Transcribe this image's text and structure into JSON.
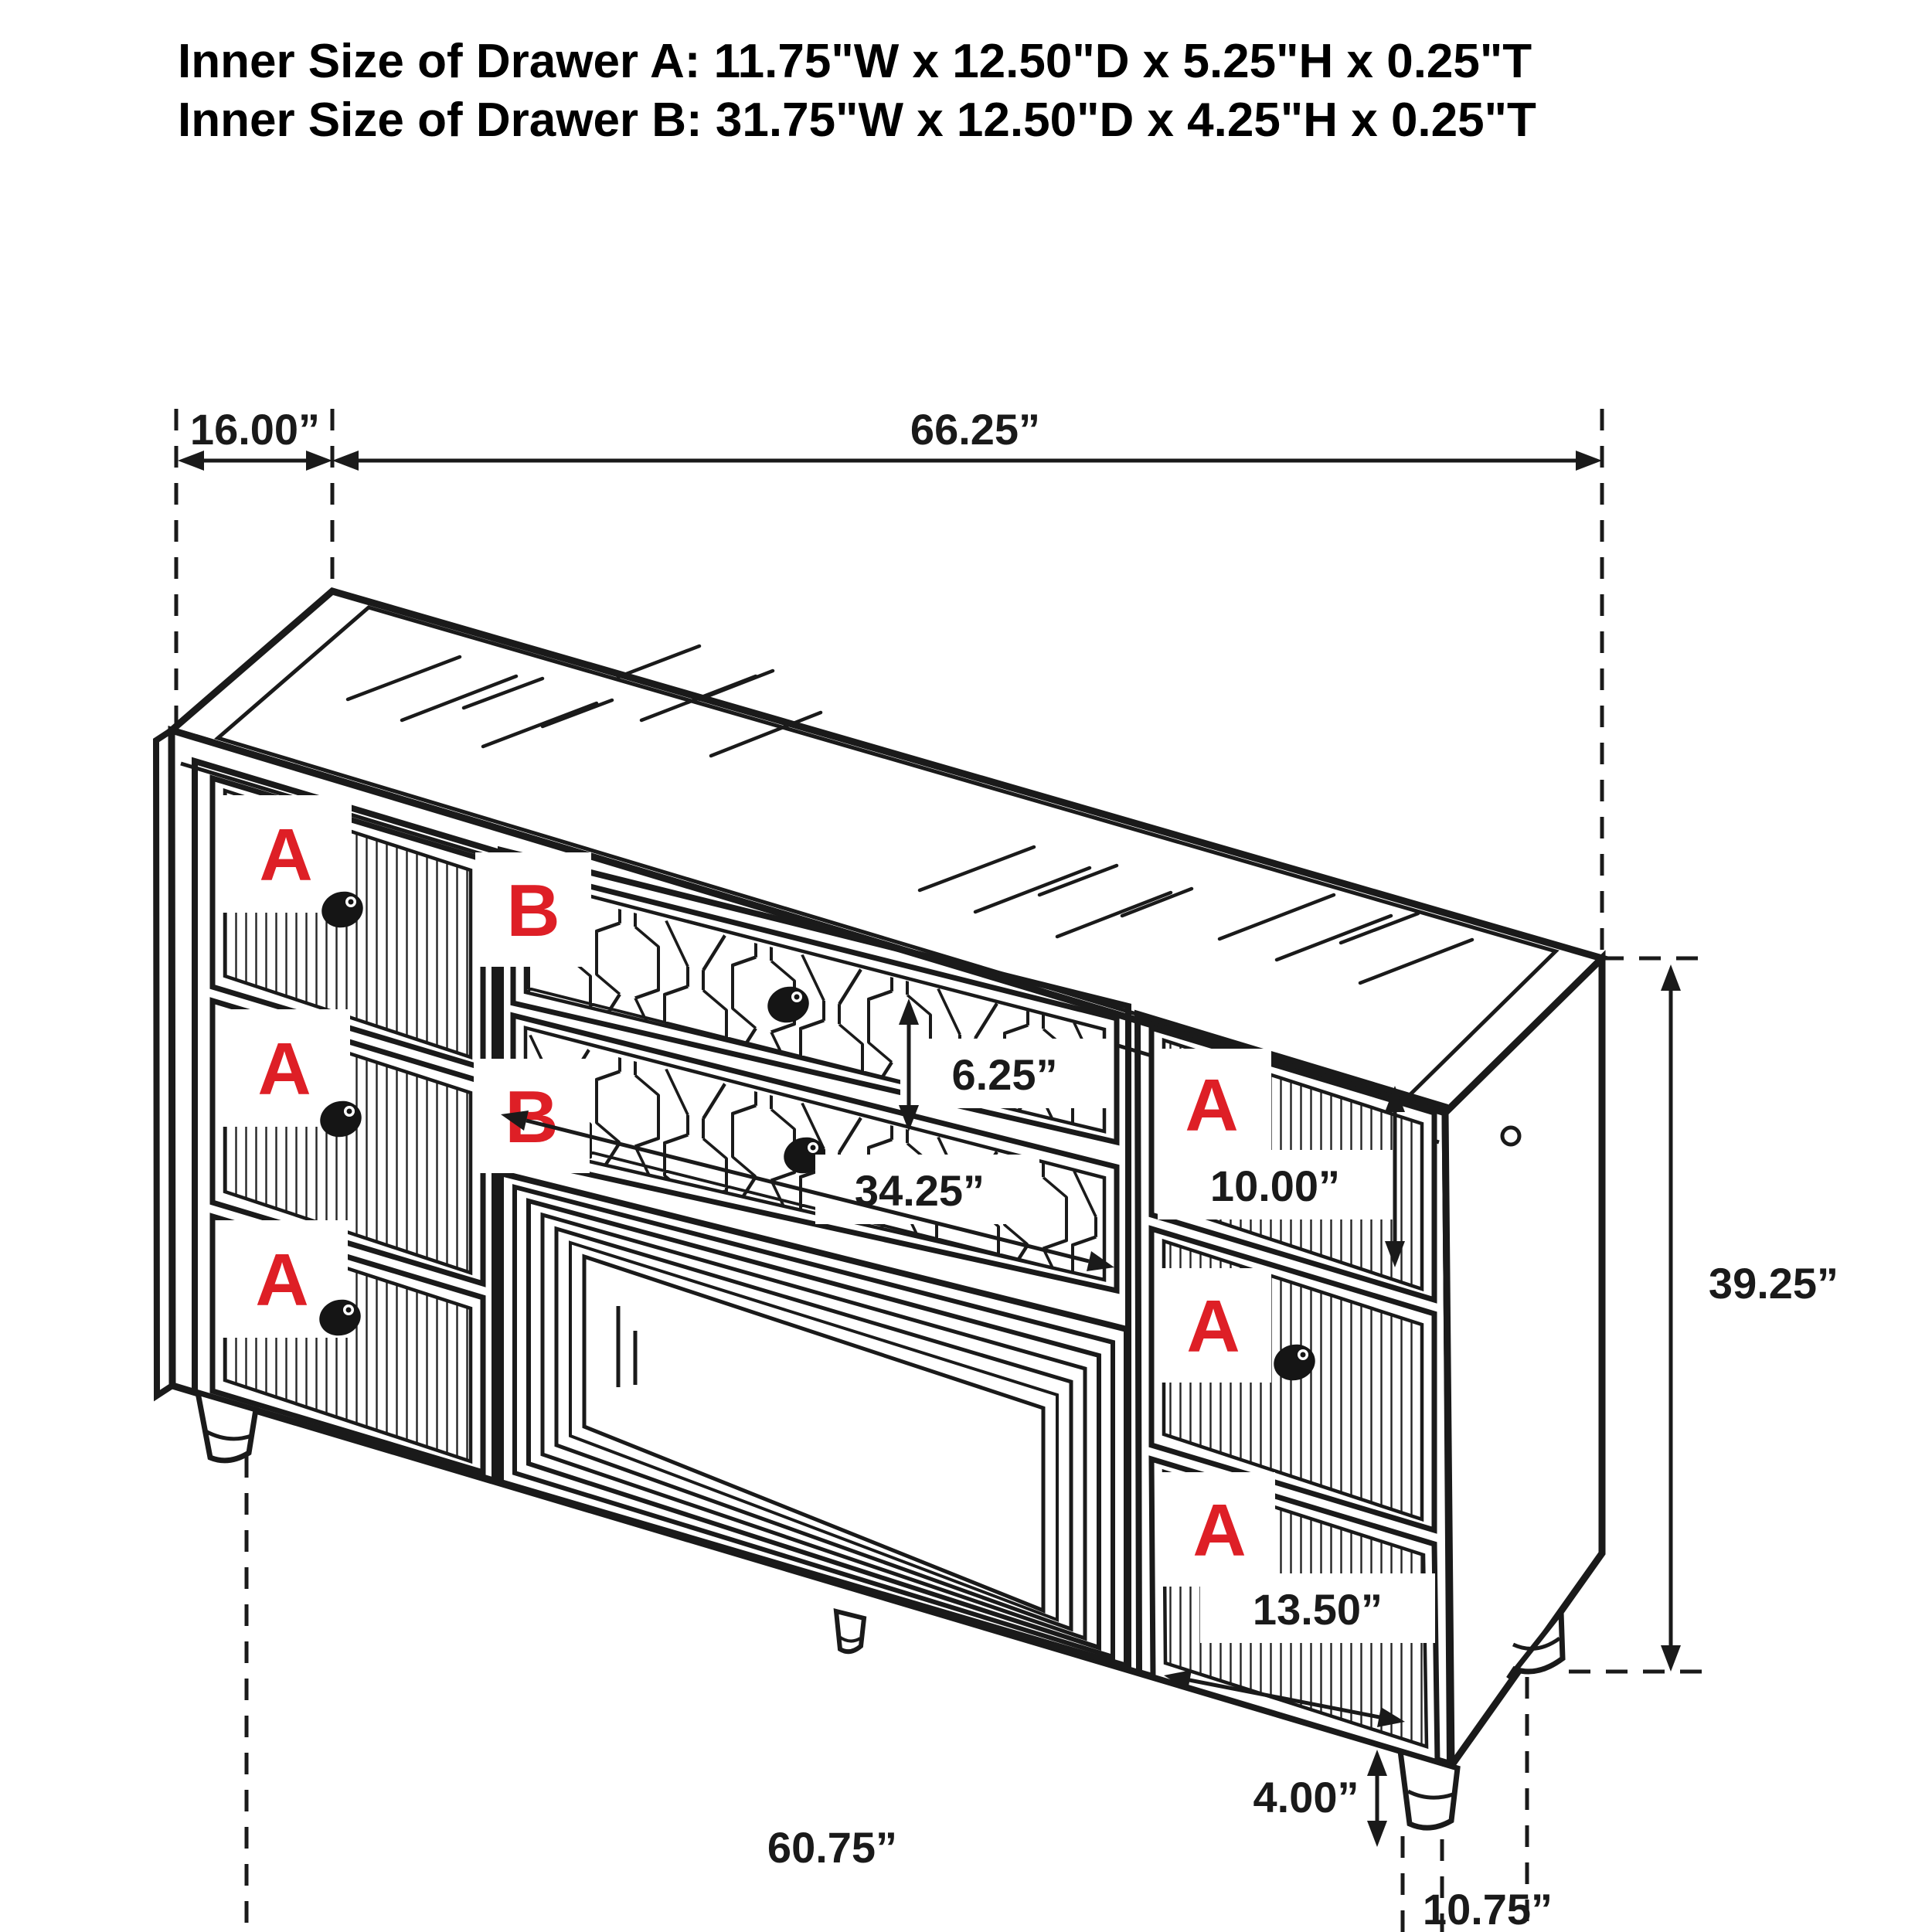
{
  "title": {
    "line1": "Inner Size of Drawer A: 11.75\"W x 12.50\"D x 5.25\"H x 0.25\"T",
    "line2": "Inner Size of Drawer B: 31.75\"W x 12.50\"D x 4.25\"H x 0.25\"T"
  },
  "dimensions": {
    "depth": "16.00”",
    "width": "66.25”",
    "drawer_b_height": "6.25”",
    "drawer_b_width": "34.25”",
    "right_top_drawer_height": "10.00”",
    "cabinet_height": "39.25”",
    "right_bottom_drawer_width": "13.50”",
    "leg_height": "4.00”",
    "base_width": "60.75”",
    "leg_inset_depth": "10.75”"
  },
  "labels": {
    "drawer_a": "A",
    "drawer_b": "B"
  },
  "colors": {
    "line": "#1a1a1a",
    "accent_red": "#de1f26",
    "background": "#ffffff"
  }
}
